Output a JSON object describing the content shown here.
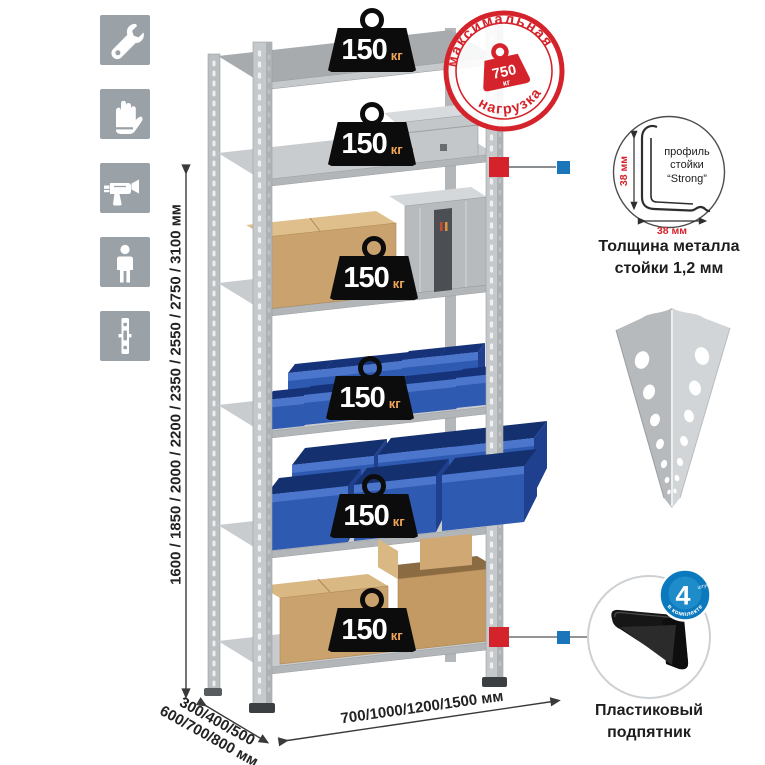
{
  "sidebar_icons": {
    "items": [
      {
        "icon": "wrench-icon"
      },
      {
        "icon": "gloves-icon"
      },
      {
        "icon": "drill-icon"
      },
      {
        "icon": "person-icon"
      },
      {
        "icon": "rack-post-icon"
      }
    ]
  },
  "dimensions": {
    "height_options": "1600 / 1850 / 2000 / 2200 / 2350 / 2550 / 2750 / 3100 мм",
    "depth_options_line1": "300/400/500",
    "depth_options_line2": "600/700/800 мм",
    "width_options": "700/1000/1200/1500 мм"
  },
  "shelf_load_badge": {
    "value": "150",
    "unit": "кг"
  },
  "max_load_stamp": {
    "arc_top": "максимальная",
    "arc_bottom": "нагрузка",
    "weight_value": "750",
    "weight_unit": "кг"
  },
  "profile_detail": {
    "label_line1": "профиль",
    "label_line2": "стойки",
    "label_line3": "“Strong”",
    "dim_vertical": "38 мм",
    "dim_horizontal": "38 мм",
    "caption_line1": "Толщина металла",
    "caption_line2": "стойки 1,2 мм"
  },
  "foot_detail": {
    "badge_value": "4",
    "badge_small": "штуки",
    "badge_arc": "в комплекте",
    "caption_line1": "Пластиковый",
    "caption_line2": "подпятник"
  },
  "colors": {
    "stamp_red": "#d5232b",
    "marker_red": "#d5232b",
    "marker_blue": "#1b75bb",
    "bin_blue": "#2f5ab2",
    "badge_black": "#0c0c0c",
    "unit_orange": "#f2a559",
    "icon_tile_gray": "#9aa1a7"
  }
}
